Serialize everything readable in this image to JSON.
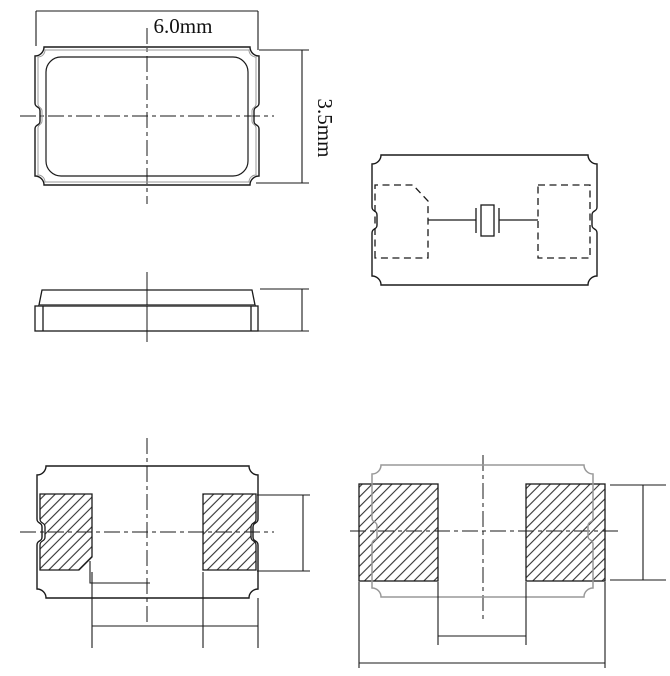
{
  "dimensions": {
    "width_label": "6.0mm",
    "height_label": "3.5mm"
  },
  "colors": {
    "line": "#1a1a1a",
    "light_outline": "#999999",
    "hatch": "#333333",
    "background": "#ffffff"
  }
}
